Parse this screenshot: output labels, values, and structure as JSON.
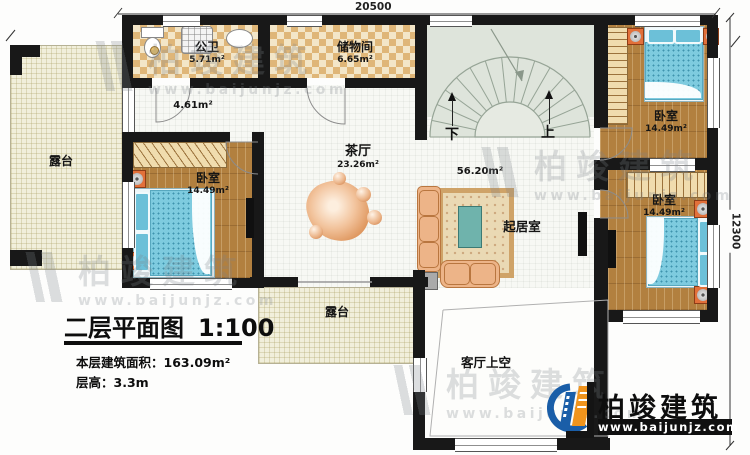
{
  "dimensions": {
    "top": "20500",
    "right": "12300"
  },
  "rooms": {
    "bath": {
      "name": "公卫",
      "area": "5.71m²"
    },
    "storage": {
      "name": "储物间",
      "area": "6.65m²"
    },
    "hallway": {
      "area": "4.61m²"
    },
    "tea_hall": {
      "name": "茶厅",
      "area": "23.26m²"
    },
    "center": {
      "area": "56.20m²"
    },
    "stairs": {
      "down": "下",
      "up": "上"
    },
    "bedroom_left": {
      "name": "卧室",
      "area": "14.49m²"
    },
    "bedroom_top_right": {
      "name": "卧室",
      "area": "14.49m²"
    },
    "bedroom_bottom_right": {
      "name": "卧室",
      "area": "14.49m²"
    },
    "living": {
      "name": "起居室"
    },
    "terrace_left": {
      "name": "露台"
    },
    "terrace_bottom": {
      "name": "露台"
    },
    "void": {
      "name": "客厅上空"
    }
  },
  "title_block": {
    "title": "二层平面图",
    "scale": "1:100",
    "area_line": "本层建筑面积：163.09m²",
    "floor_height_line": "层高：3.3m"
  },
  "brand": {
    "name": "柏竣建筑",
    "website": "www.baijunjz.com"
  },
  "watermark": {
    "name": "柏竣建筑",
    "website": "www.baijunjz.com"
  },
  "colors": {
    "wall": "#181818",
    "wood": "#b2803f",
    "bed_blue": "#7ecbdf",
    "checker": "#dfb678",
    "terrace": "#f1efdb",
    "stairs": "#dee4db",
    "brand_blue": "#1a5ea8",
    "brand_orange": "#f0941d"
  }
}
